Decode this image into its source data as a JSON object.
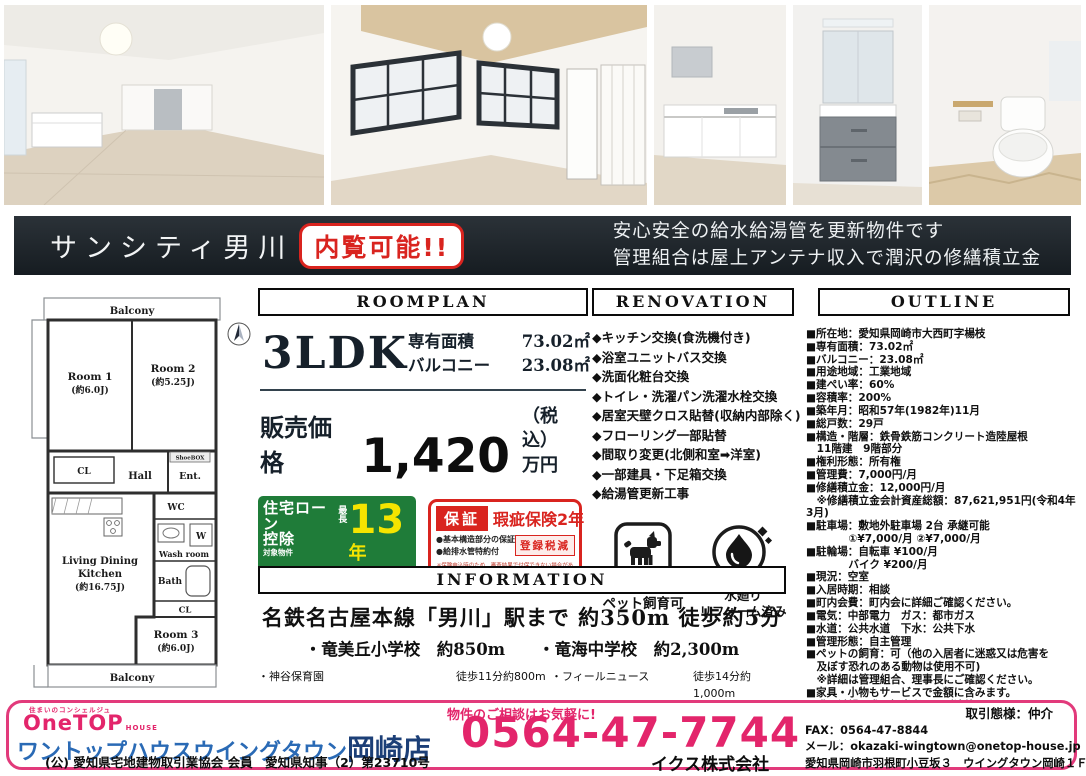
{
  "banner": {
    "title": "サンシティ男川",
    "badge": "内覧可能!!",
    "line1": "安心安全の給水給湯管を更新物件です",
    "line2": "管理組合は屋上アンテナ収入で潤沢の修繕積立金"
  },
  "floorplan": {
    "balcony_top": "Balcony",
    "room1": "Room 1",
    "room1_size": "(約6.0J)",
    "room2": "Room 2",
    "room2_size": "(約5.25J)",
    "shoebox": "ShoeBOX",
    "cl_upper": "CL",
    "hall": "Hall",
    "ent": "Ent.",
    "wc": "WC",
    "w": "W",
    "washroom": "Wash room",
    "bath": "Bath",
    "cl_lower": "CL",
    "ldk_line1": "Living Dining",
    "ldk_line2": "Kitchen",
    "ldk_size": "(約16.75J)",
    "room3": "Room 3",
    "room3_size": "(約6.0J)",
    "balcony_bottom": "Balcony"
  },
  "roomplan": {
    "header": "ROOMPLAN",
    "layout": "3LDK",
    "area_label": "専有面積",
    "area_value": "73.02㎡",
    "balcony_label": "バルコニー",
    "balcony_value": "23.08㎡",
    "price_label": "販売価格",
    "price_value": "1,420",
    "tax_note": "（税込）",
    "price_unit": "万円"
  },
  "loan_badge": {
    "title1": "住宅ローン",
    "title2": "控除",
    "subject": "対象物件",
    "max_label": "最長",
    "years": "13",
    "years_unit": "年",
    "cert": "「増改築工事証明書」",
    "free": "無料発行",
    "note": "本税制控除には諸条件があり、優遇されない場合もあります。"
  },
  "warranty_badge": {
    "label": "保証",
    "title": "瑕疵保険2年",
    "point1": "●基本構造部分の保証",
    "point2": "●給排水管特約付",
    "tax": "登録税減",
    "note": "※保険申込時のため、審査結果で付保できない場合があります。"
  },
  "perks": {
    "pet_label": "ペット飼育可",
    "water_label1": "水廻り",
    "water_label2": "リフォーム済み"
  },
  "icons": {
    "pet": "dog-icon",
    "water": "water-drop-icon",
    "compass": "compass-icon"
  },
  "renovation": {
    "header": "RENOVATION",
    "items": [
      "◆キッチン交換(食洗機付き)",
      "◆浴室ユニットバス交換",
      "◆洗面化粧台交換",
      "◆トイレ・洗濯パン洗濯水栓交換",
      "◆居室天壁クロス貼替(収納内部除く)",
      "◆フローリング一部貼替",
      "◆間取り変更(北側和室➡洋室)",
      "◆一部建具・下足箱交換",
      "◆給湯管更新工事"
    ]
  },
  "outline": {
    "header": "OUTLINE",
    "items": [
      "■所在地：愛知県岡崎市大西町字楊枝",
      "■専有面積：73.02㎡",
      "■バルコニー：23.08㎡",
      "■用途地域：工業地域",
      "■建ぺい率：60%",
      "■容積率：200%",
      "■築年月：昭和57年(1982年)11月",
      "■総戸数：29戸",
      "■構造・階層：鉄骨鉄筋コンクリート造陸屋根",
      "　11階建　9階部分",
      "■権利形態：所有権",
      "■管理費：7,000円/月",
      "■修繕積立金：12,000円/月",
      "　※修繕積立金会計資産総額：87,621,951円(令和4年3月)",
      "■駐車場：敷地外駐車場 2台 承継可能",
      "　　　　①¥7,000/月 ②¥7,000/月",
      "■駐輪場：自転車 ¥100/月",
      "　　　　バイク ¥200/月",
      "■現況：空室",
      "■入居時期：相談",
      "■町内会費：町内会に詳細ご確認ください。",
      "■電気：中部電力　ガス：都市ガス",
      "■水道：公共水道　下水：公共下水",
      "■管理形態：自主管理",
      "■ペットの飼育：可（他の入居者に迷惑又は危害を",
      "　及ぼす恐れのある動物は使用不可)",
      "　※詳細は管理組合、理事長にご確認ください。",
      "■家具・小物もサービスで金額に含みます。",
      "■購入希望の際は担当者までご連絡ください。",
      "　融資承認が購入申込の必須条件です"
    ]
  },
  "information": {
    "header": "INFORMATION",
    "station_line": "名鉄名古屋本線「男川」駅まで 約350m 徒歩約5分",
    "schools_line": "・竜美丘小学校　約850m　　・竜海中学校　約2,300m",
    "places": [
      {
        "n1": "・神谷保育園",
        "d1": "徒歩11分約800m",
        "n2": "・フィールニュース",
        "d2": "徒歩14分約1,000m"
      },
      {
        "n1": "・ファミリーマート岡崎竜美台二丁目店",
        "d1": "徒歩2分約100m",
        "n2": "・神殿公園",
        "d2": "徒歩5分約350m"
      },
      {
        "n1": "・岡崎竜美丘郵便局",
        "d1": "徒歩2分約93m",
        "n2": "・小村内科クリニック",
        "d2": "徒歩11分約850m"
      },
      {
        "n1": "・ココカラファインジップドラッグ竜美ヶ丘店",
        "d1": "徒歩14分約1,100m",
        "n2": "",
        "d2": ""
      }
    ]
  },
  "footer": {
    "tagline": "住まいのコンシェルジュ",
    "logo": "OneTOP",
    "logo_sub": "HOUSE",
    "shop_name_main": "ワントップハウスウイングタウン",
    "shop_name_branch": "岡崎店",
    "license": "(公) 愛知県宅地建物取引業協会 会員　愛知県知事（2）第23710号",
    "note": "物件のご相談はお気軽に!",
    "phone": "0564-47-7744",
    "agency": "イクス株式会社",
    "deal_type": "取引態様：仲介",
    "fax": "FAX：0564-47-8844",
    "email": "メール：okazaki-wingtown@onetop-house.jp",
    "address": "愛知県岡崎市羽根町小豆坂３　ウイングタウン岡崎１Ｆ"
  },
  "colors": {
    "accent_pink": "#e3256b",
    "accent_red": "#d9241f",
    "loan_green": "#1f7c39",
    "loan_yellow": "#f5e400",
    "banner_bg": "#1d242a",
    "brand_blue": "#2a6ab5",
    "brand_navy": "#1c3f77"
  }
}
